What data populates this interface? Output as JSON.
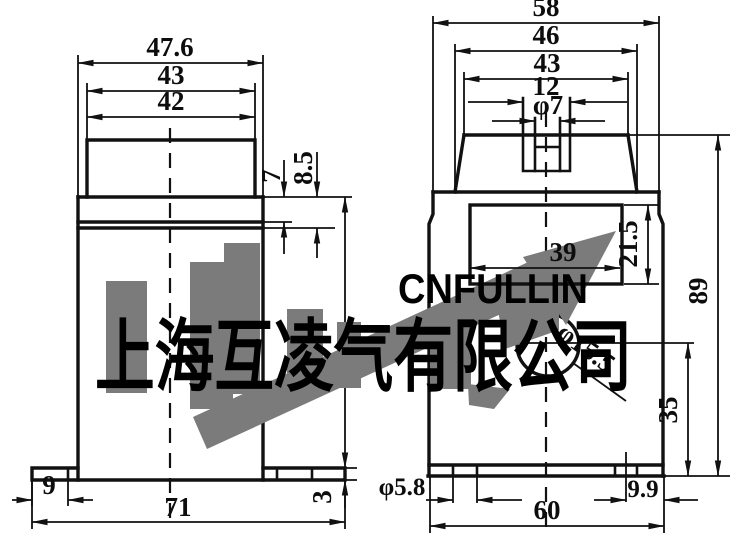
{
  "watermark": {
    "company": "上海互凌气有限公司",
    "brand": "CNFULLIN"
  },
  "front_view": {
    "width_flange": "47.6",
    "width_cap_outer": "43",
    "width_cap_inner": "42",
    "collar_step": "7",
    "collar_height": "8.5",
    "foot_width": "9",
    "base_width": "71",
    "base_thickness": "3"
  },
  "side_view": {
    "width_overall": "58",
    "width_shoulder": "46",
    "width_top": "43",
    "terminal_width": "12",
    "terminal_hole": "φ7",
    "window_width": "39",
    "window_height": "21.5",
    "height_overall": "89",
    "center_hole": "φ15.5",
    "hole_center_height": "35",
    "slot_width": "φ5.8",
    "slot_offset": "9.9",
    "base_width": "60"
  },
  "colors": {
    "line": "#111111",
    "watermark_gray": "#7b7b7b",
    "background": "#ffffff"
  }
}
